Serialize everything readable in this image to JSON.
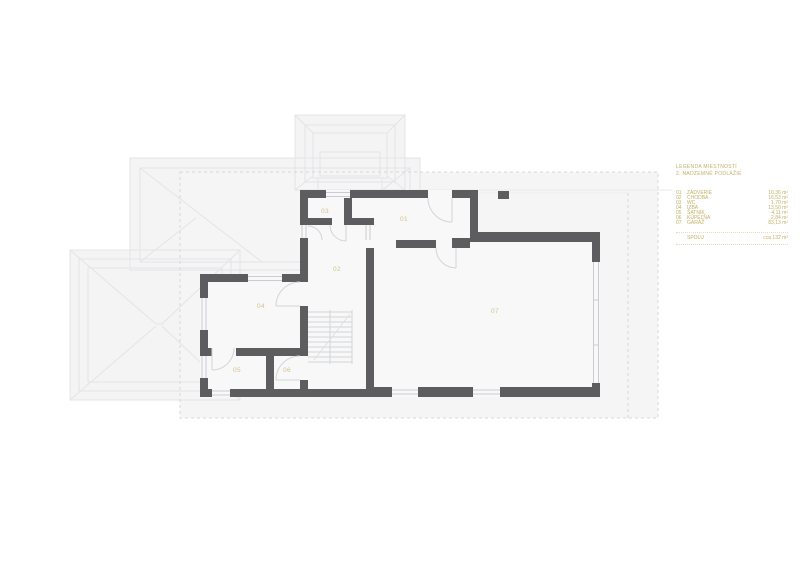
{
  "legend": {
    "title_line1": "LEGENDA MIESTNOSTÍ",
    "title_line2": "2. NADZEMNÉ PODLAŽIE",
    "rows": [
      {
        "num": "01",
        "name": "ZÁDVERIE",
        "area": "10,36 m²"
      },
      {
        "num": "02",
        "name": "CHODBA",
        "area": "16,53 m²"
      },
      {
        "num": "03",
        "name": "WC",
        "area": "1,70 m²"
      },
      {
        "num": "04",
        "name": "IZBA",
        "area": "13,50 m²"
      },
      {
        "num": "05",
        "name": "ŠATNÍK",
        "area": "4,11 m²"
      },
      {
        "num": "06",
        "name": "KÚPEĽŇA",
        "area": "2,84 m²"
      },
      {
        "num": "07",
        "name": "GARÁŽ",
        "area": "83,13 m²"
      }
    ],
    "total_label": "SPOLU",
    "total_value": "cca 132 m²"
  },
  "plan": {
    "room_labels": [
      "01",
      "02",
      "03",
      "04",
      "05",
      "06",
      "07"
    ]
  },
  "colors": {
    "accent_gold": "#c2b066",
    "room_label_gold": "#cfc38c",
    "wall_gray": "#5d5d5f",
    "roof_line": "#e4e4e6",
    "thin_line": "#c9cdd1"
  }
}
